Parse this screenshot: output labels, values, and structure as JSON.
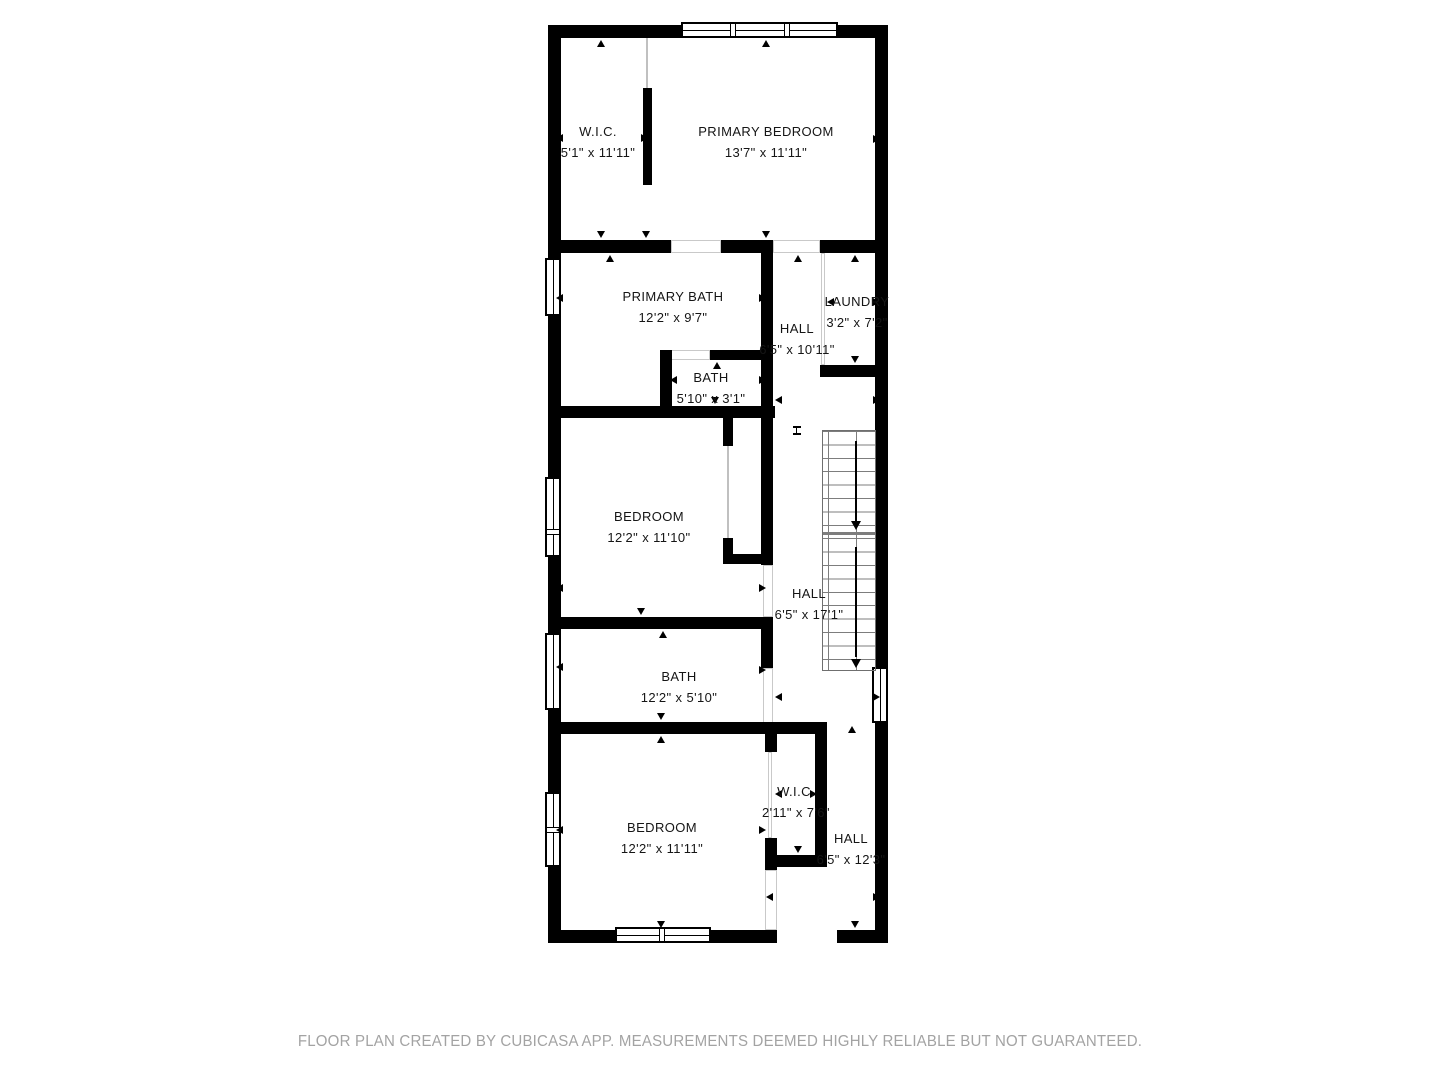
{
  "plan": {
    "rooms": [
      {
        "name": "W.I.C.",
        "dims": "5'1\" x 11'11\""
      },
      {
        "name": "PRIMARY BEDROOM",
        "dims": "13'7\" x 11'11\""
      },
      {
        "name": "PRIMARY BATH",
        "dims": "12'2\" x 9'7\""
      },
      {
        "name": "HALL",
        "dims": "6'5\" x 10'11\""
      },
      {
        "name": "LAUNDRY",
        "dims": "3'2\" x 7'2\""
      },
      {
        "name": "BATH",
        "dims": "5'10\" x 3'1\""
      },
      {
        "name": "BEDROOM",
        "dims": "12'2\" x 11'10\""
      },
      {
        "name": "HALL",
        "dims": "6'5\" x 17'1\""
      },
      {
        "name": "BATH",
        "dims": "12'2\" x 5'10\""
      },
      {
        "name": "BEDROOM",
        "dims": "12'2\" x 11'11\""
      },
      {
        "name": "W.I.C.",
        "dims": "2'11\" x 7'6\""
      },
      {
        "name": "HALL",
        "dims": "6'5\" x 12'3\""
      }
    ],
    "colors": {
      "wall": "#000000",
      "label": "#151515",
      "stair_line": "#7d7d7d",
      "footer": "#a3a3a3",
      "background": "#ffffff"
    }
  },
  "footer": {
    "disclaimer": "FLOOR PLAN CREATED BY CUBICASA APP. MEASUREMENTS DEEMED HIGHLY RELIABLE BUT NOT GUARANTEED."
  }
}
